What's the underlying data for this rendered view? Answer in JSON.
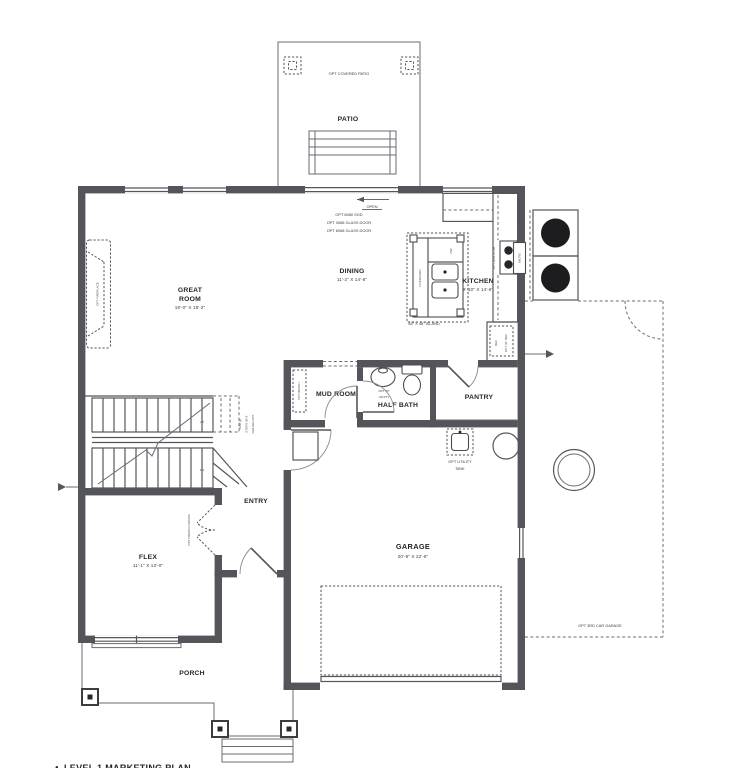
{
  "plan": {
    "patio": {
      "opt_label": "OPT COVERED PATIO",
      "name": "PATIO"
    },
    "rear_door": {
      "open": "OPEN",
      "opt1": "OPT 8080 SGD",
      "opt2": "OPT 3068 GLASS DOOR",
      "opt3": "OPT 6068 GLASS DOOR"
    },
    "great_room": {
      "name1": "GREAT",
      "name2": "ROOM",
      "dims": "18'-0\" X 18'-2\"",
      "fireplace": "OPT FIREPLACE"
    },
    "dining": {
      "name": "DINING",
      "dims": "11'-2\" X 14'-6\""
    },
    "kitchen": {
      "name": "KITCHEN",
      "dims": "9'-10\" X 14'-6\"",
      "island": "84\" X 48\" ISLAND",
      "overhang": "OVERHANG",
      "dw": "DW",
      "gas_stub": "OPT GAS STUB",
      "micro": "MICRO",
      "ref": "REF",
      "ref_note": "OPT 36\" REF"
    },
    "mud_room": {
      "name": "MUD ROOM",
      "bench": "OPT BENCH"
    },
    "half_bath": {
      "name": "HALF BATH",
      "vanity1": "OPT 30\"",
      "vanity2": "VANITY"
    },
    "pantry": {
      "name": "PANTRY"
    },
    "stairs": {
      "up": "UP",
      "dn": "DN",
      "opt1": "ADD (2)",
      "opt2": "STEPS W/ 9'",
      "opt3": "CEILING OPT"
    },
    "entry": {
      "name": "ENTRY"
    },
    "flex": {
      "name": "FLEX",
      "dims": "11'-1\" X 13'-0\"",
      "french_doors": "OPT FRENCH DOORS"
    },
    "garage": {
      "name": "GARAGE",
      "dims": "20'-9\" X 22'-6\"",
      "utility1": "OPT UTILITY",
      "utility2": "SINK",
      "third_car": "OPT 3RD CAR GARAGE"
    },
    "porch": {
      "name": "PORCH"
    },
    "footer": {
      "bullet": "●",
      "label": "LEVEL 1 MARKETING PLAN"
    }
  },
  "colors": {
    "wall": "#54555a",
    "line": "#55565c",
    "dashed": "#6c6d72",
    "text": "#26262a",
    "background": "#ffffff"
  }
}
